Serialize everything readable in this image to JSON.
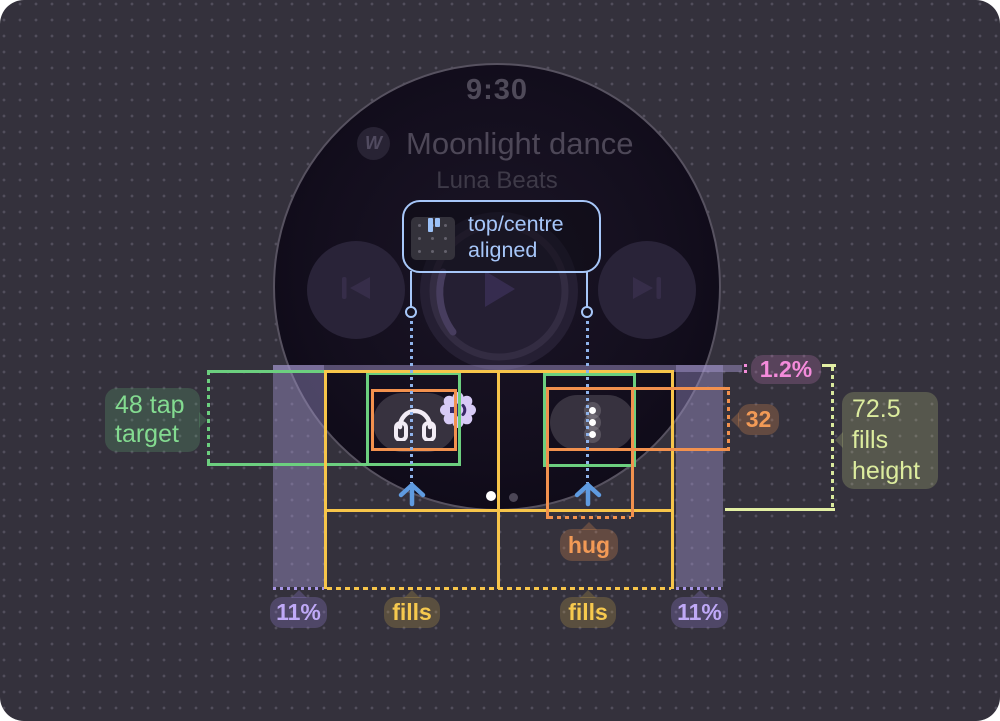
{
  "watch": {
    "time": "9:30",
    "title": "Moonlight dance",
    "artist": "Luna Beats",
    "logo_glyph": "W"
  },
  "callout": {
    "line1": "top/centre",
    "line2": "aligned"
  },
  "annotations": {
    "tap_target": {
      "line1": "48 tap",
      "line2": "target"
    },
    "gap_percent": "1.2%",
    "button_height": "32",
    "fills_height": {
      "line1": "72.5",
      "line2": "fills",
      "line3": "height"
    },
    "hug": "hug",
    "fills": "fills",
    "side_margin": "11%"
  },
  "icons": {
    "logo": "music-brand-mark",
    "headphones": "headphones",
    "volume_badge": "speaker-volume",
    "overflow": "vertical-ellipsis-dots",
    "skip_previous": "skip-previous",
    "play": "play",
    "skip_next": "skip-next",
    "align_glyph": "align-top-centre",
    "up_arrow": "up-arrow",
    "page_indicator": "page-dots"
  },
  "colors": {
    "background": "#34313c",
    "guide_yellow": "#f7c54a",
    "guide_orange": "#f2914e",
    "guide_green": "#6ccf7f",
    "guide_lime": "#e3efa4",
    "guide_blue": "#a7c7f9",
    "guide_pink": "#f28bd9",
    "margin_band": "#a89cd8",
    "badge_purple_text": "#bfa9f7",
    "watch_face": "#120e1b"
  }
}
